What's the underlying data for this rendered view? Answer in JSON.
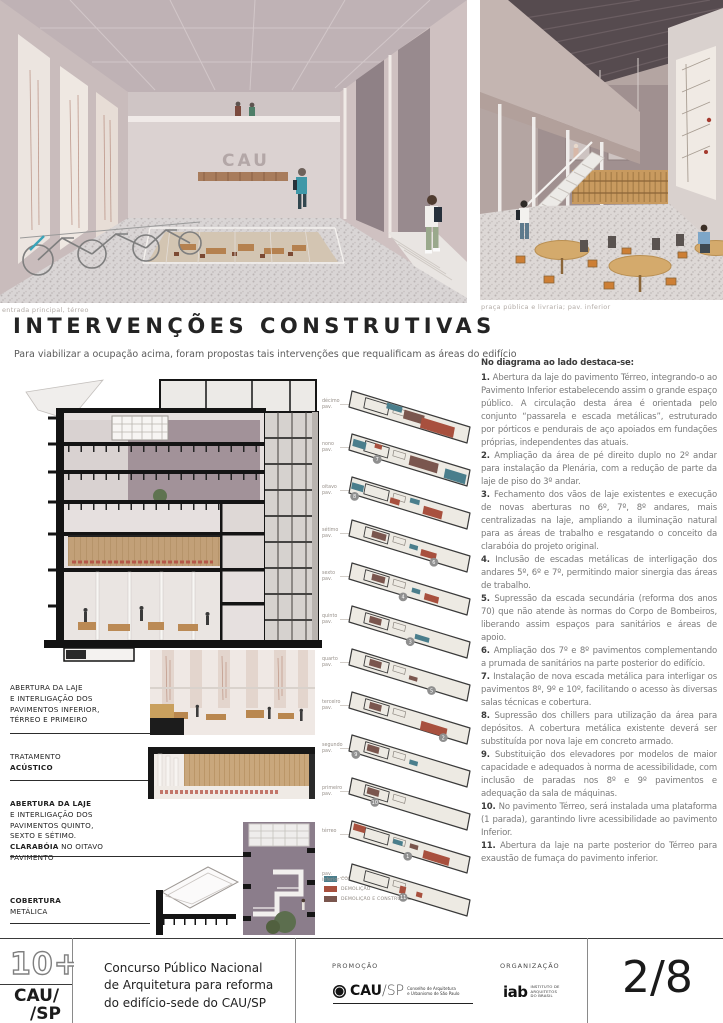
{
  "board": {
    "captions": {
      "left": "entrada principal, térreo",
      "right": "praça pública e livraria; pav. inferior"
    },
    "title": "INTERVENÇÕES CONSTRUTIVAS",
    "subtitle": "Para viabilizar a ocupação acima, foram propostas tais intervenções que requalificam as áreas do edifício",
    "cau_sign": "CAU"
  },
  "interventions": {
    "heading": "No diagrama ao lado destaca-se:",
    "items": [
      {
        "n": "1.",
        "text": "Abertura da laje do pavimento Térreo, integrando-o ao Pavimento Inferior estabelecendo assim o grande espaço público. A circulação desta área é orientada pelo conjunto “passarela e escada metálicas”, estruturado por pórticos e pendurais de aço apoiados em fundações próprias, independentes das atuais."
      },
      {
        "n": "2.",
        "text": "Ampliação da área de pé direito duplo no 2º andar para instalação da Plenária, com a redução de parte da laje de piso do 3º andar."
      },
      {
        "n": "3.",
        "text": "Fechamento dos vãos de laje existentes e execução de novas aberturas no 6º, 7º, 8º andares, mais centralizadas na laje, ampliando a iluminação natural para as áreas de trabalho e resgatando o conceito da clarabóia do projeto original."
      },
      {
        "n": "4.",
        "text": "Inclusão de escadas metálicas de interligação dos andares 5º, 6º e 7º, permitindo maior sinergia das áreas de trabalho."
      },
      {
        "n": "5.",
        "text": "Supressão da escada secundária (reforma dos anos 70) que não atende às normas do Corpo de Bombeiros, liberando assim espaços para sanitários e áreas de apoio."
      },
      {
        "n": "6.",
        "text": "Ampliação dos 7º e 8º pavimentos complementando a prumada de sanitários na parte posterior do edifício."
      },
      {
        "n": "7.",
        "text": "Instalação de nova escada metálica para interligar os pavimentos 8º, 9º e 10º, facilitando o acesso às diversas salas técnicas e cobertura."
      },
      {
        "n": "8.",
        "text": "Supressão dos chillers para utilização da área para depósitos. A cobertura metálica existente deverá ser substituída por nova laje em concreto armado."
      },
      {
        "n": "9.",
        "text": "Substituição dos elevadores por modelos de maior capacidade e adequados à norma de acessibilidade, com inclusão de paradas nos 8º e 9º pavimentos e adequação da sala de máquinas."
      },
      {
        "n": "10.",
        "text": "No pavimento Térreo, será instalada uma plataforma (1 parada), garantindo livre acessibilidade ao pavimento Inferior."
      },
      {
        "n": "11.",
        "text": "Abertura da laje na parte posterior do Térreo para exaustão de fumaça do pavimento inferior."
      }
    ]
  },
  "annotations": [
    {
      "lines": [
        {
          "t": "ABERTURA DA LAJE",
          "b": false
        },
        {
          "t": "E INTERLIGAÇÃO DOS",
          "b": false
        },
        {
          "t": "PAVIMENTOS INFERIOR,",
          "b": false
        },
        {
          "t": "TÉRREO E PRIMEIRO",
          "b": false
        }
      ]
    },
    {
      "lines": [
        {
          "t": "TRATAMENTO",
          "b": false
        },
        {
          "t": "ACÚSTICO",
          "b": true
        }
      ]
    },
    {
      "lines": [
        {
          "t": "ABERTURA DA LAJE",
          "b": true
        },
        {
          "t": "E INTERLIGAÇÃO DOS",
          "b": false
        },
        {
          "t": "PAVIMENTOS QUINTO,",
          "b": false
        },
        {
          "t": "SEXTO E SÉTIMO.",
          "b": false
        },
        {
          "t": "CLARABÓIA",
          "b": true
        },
        {
          "t": " NO OITAVO",
          "b": false
        },
        {
          "t": "PAVIMENTO",
          "b": false
        }
      ]
    },
    {
      "lines": [
        {
          "t": "COBERTURA",
          "b": true
        },
        {
          "t": "METÁLICA",
          "b": false
        }
      ]
    }
  ],
  "diagram": {
    "colors": {
      "teal": "#4a7e8c",
      "rust": "#a8503e",
      "brown": "#7a564e",
      "plate": "#edeae3",
      "outline": "#3a3a3a"
    },
    "floors": [
      {
        "label1": "décimo",
        "label2": "pav.",
        "patches": [
          [
            0.3,
            0.05,
            0.13,
            0.35,
            "teal"
          ],
          [
            0.45,
            0.15,
            0.17,
            0.55,
            "brown"
          ],
          [
            0.6,
            0.3,
            0.28,
            0.65,
            "rust"
          ]
        ],
        "marker": null
      },
      {
        "label1": "nono",
        "label2": "pav.",
        "patches": [
          [
            0.02,
            0.25,
            0.11,
            0.45,
            "teal"
          ],
          [
            0.2,
            0.12,
            0.06,
            0.28,
            "rust"
          ],
          [
            0.5,
            0.2,
            0.24,
            0.6,
            "brown"
          ],
          [
            0.8,
            0.35,
            0.18,
            0.58,
            "teal"
          ]
        ],
        "marker": {
          "n": "7",
          "t": 0.24,
          "s": 1.05
        }
      },
      {
        "label1": "oitavo",
        "label2": "pav.",
        "patches": [
          [
            0.01,
            0.3,
            0.1,
            0.4,
            "teal"
          ],
          [
            0.34,
            0.5,
            0.08,
            0.34,
            "rust"
          ],
          [
            0.5,
            0.16,
            0.08,
            0.3,
            "teal"
          ],
          [
            0.62,
            0.4,
            0.16,
            0.5,
            "rust"
          ]
        ],
        "marker": {
          "n": "8",
          "t": 0.05,
          "s": 1.1
        }
      },
      {
        "label1": "sétimo",
        "label2": "pav.",
        "patches": [
          [
            0.18,
            0.25,
            0.12,
            0.4,
            "brown"
          ],
          [
            0.5,
            0.35,
            0.07,
            0.28,
            "teal"
          ],
          [
            0.6,
            0.46,
            0.13,
            0.4,
            "rust"
          ]
        ],
        "marker": {
          "n": "6",
          "t": 0.72,
          "s": 1.02
        }
      },
      {
        "label1": "sexto",
        "label2": "pav.",
        "patches": [
          [
            0.18,
            0.25,
            0.11,
            0.4,
            "brown"
          ],
          [
            0.52,
            0.36,
            0.07,
            0.28,
            "teal"
          ],
          [
            0.63,
            0.46,
            0.12,
            0.4,
            "rust"
          ]
        ],
        "marker": {
          "n": "4",
          "t": 0.46,
          "s": 1.08
        }
      },
      {
        "label1": "quinto",
        "label2": "pav.",
        "patches": [
          [
            0.16,
            0.25,
            0.1,
            0.4,
            "brown"
          ],
          [
            0.55,
            0.5,
            0.12,
            0.3,
            "teal"
          ]
        ],
        "marker": {
          "n": "3",
          "t": 0.52,
          "s": 1.06
        }
      },
      {
        "label1": "quarto",
        "label2": "pav.",
        "patches": [
          [
            0.16,
            0.25,
            0.1,
            0.4,
            "brown"
          ],
          [
            0.5,
            0.52,
            0.07,
            0.25,
            "brown"
          ]
        ],
        "marker": {
          "n": "5",
          "t": 0.7,
          "s": 1.02
        }
      },
      {
        "label1": "terceiro",
        "label2": "pav.",
        "patches": [
          [
            0.16,
            0.25,
            0.1,
            0.4,
            "brown"
          ],
          [
            0.6,
            0.45,
            0.22,
            0.55,
            "rust"
          ]
        ],
        "marker": {
          "n": "2",
          "t": 0.8,
          "s": 1.05
        }
      },
      {
        "label1": "segundo",
        "label2": "pav.",
        "patches": [
          [
            0.14,
            0.25,
            0.1,
            0.4,
            "brown"
          ],
          [
            0.5,
            0.4,
            0.07,
            0.28,
            "teal"
          ]
        ],
        "marker": {
          "n": "9",
          "t": 0.06,
          "s": 1.08
        }
      },
      {
        "label1": "primeiro",
        "label2": "pav.",
        "patches": [
          [
            0.14,
            0.25,
            0.1,
            0.4,
            "brown"
          ]
        ],
        "marker": {
          "n": "10",
          "t": 0.22,
          "s": 1.03
        }
      },
      {
        "label1": "térreo",
        "label2": "",
        "patches": [
          [
            0.02,
            0.1,
            0.1,
            0.4,
            "rust"
          ],
          [
            0.36,
            0.3,
            0.08,
            0.28,
            "teal"
          ],
          [
            0.5,
            0.26,
            0.07,
            0.28,
            "brown"
          ],
          [
            0.62,
            0.42,
            0.22,
            0.5,
            "rust"
          ]
        ],
        "marker": {
          "n": "1",
          "t": 0.5,
          "s": 1.08
        }
      },
      {
        "label1": "pav.",
        "label2": "inferior",
        "patches": [
          [
            0.42,
            0.4,
            0.05,
            0.45,
            "rust"
          ],
          [
            0.56,
            0.46,
            0.05,
            0.3,
            "rust"
          ]
        ],
        "marker": {
          "n": "11",
          "t": 0.46,
          "s": 1.05
        }
      }
    ],
    "legend": [
      {
        "label": "CONSTRUÇÃO",
        "color": "#4a7e8c"
      },
      {
        "label": "DEMOLIÇÃO",
        "color": "#a8503e"
      },
      {
        "label": "DEMOLIÇÃO E CONSTRUÇÃO POSTERIOR",
        "color": "#7a564e"
      }
    ]
  },
  "footer": {
    "logo_top": "10+",
    "logo_line1": "CAU/",
    "logo_line2": "/SP",
    "competition_lines": [
      "Concurso Público Nacional",
      "de Arquitetura para reforma",
      "do edifício-sede do CAU/SP"
    ],
    "promo_label": "PROMOÇÃO",
    "promo_logo_main": "CAU",
    "promo_logo_slash": "/SP",
    "promo_logo_sub1": "Conselho de Arquitetura",
    "promo_logo_sub2": "e Urbanismo de São Paulo",
    "org_label": "ORGANIZAÇÃO",
    "org_logo_main": "iab",
    "org_logo_sub1": "INSTITUTO DE",
    "org_logo_sub2": "ARQUITETOS",
    "org_logo_sub3": "DO BRASIL",
    "page": "2/8"
  }
}
